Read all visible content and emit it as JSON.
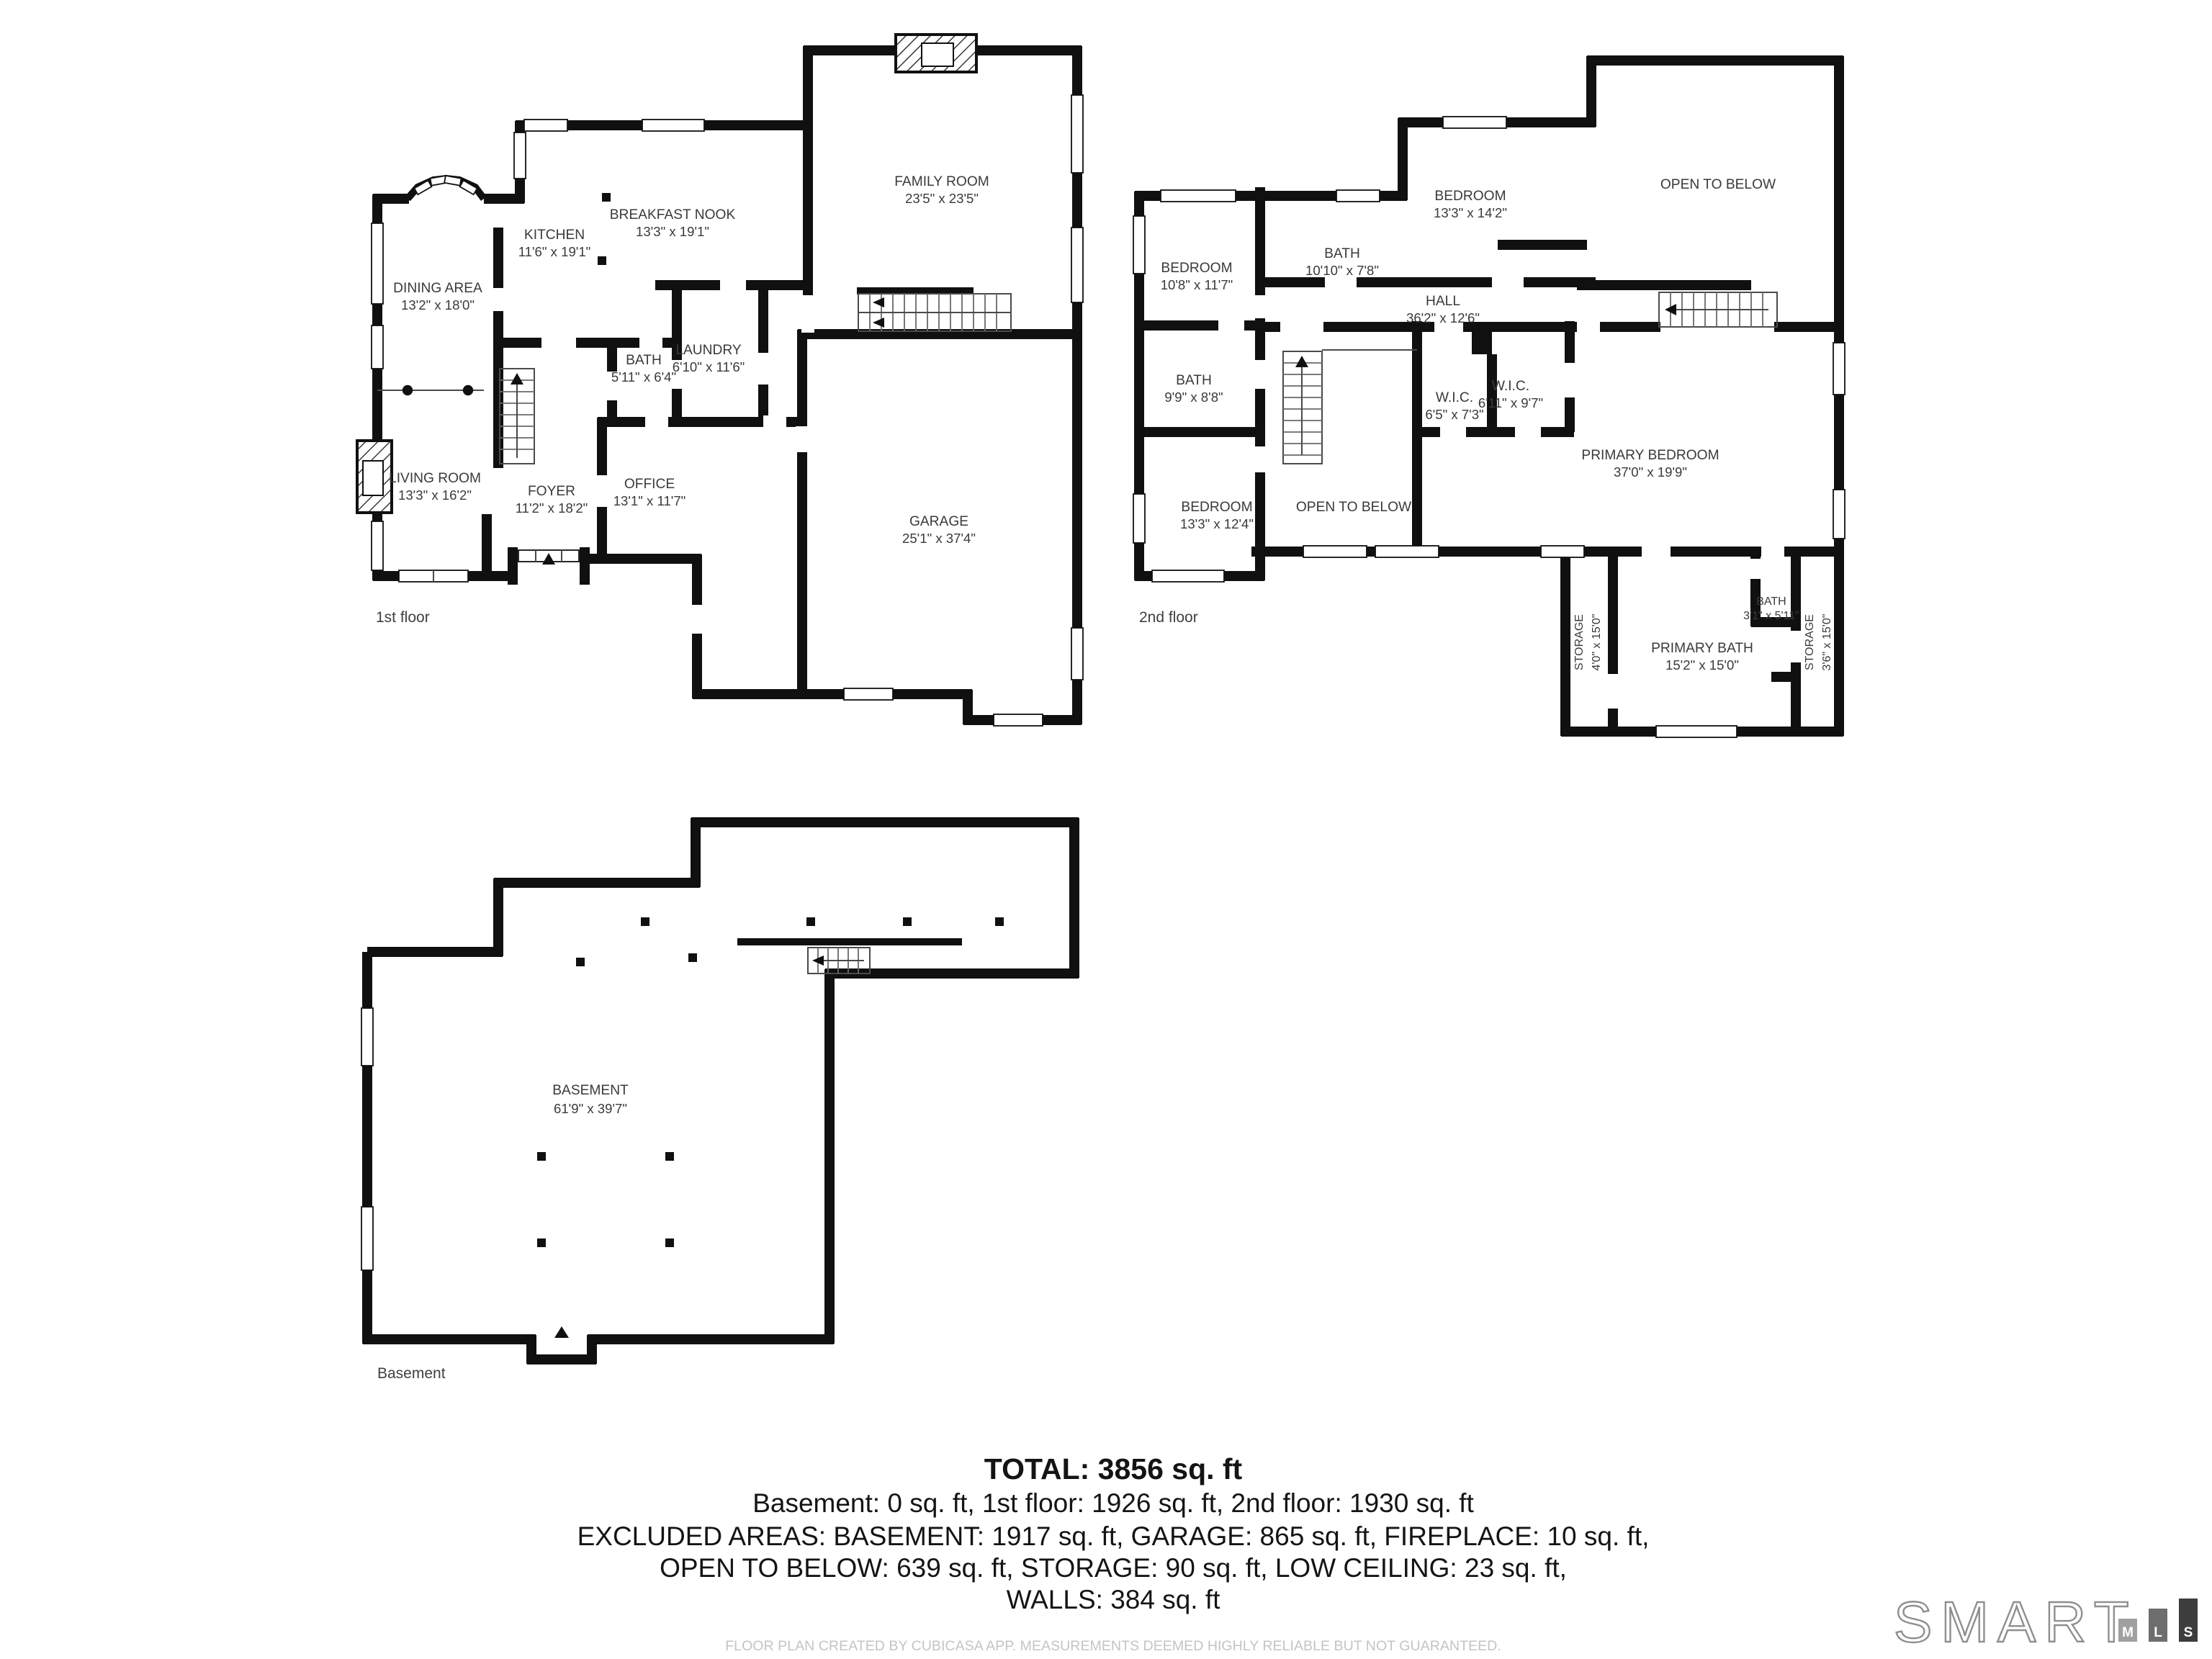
{
  "floors": {
    "first": {
      "label": "1st floor",
      "rooms": {
        "dining": {
          "name": "DINING AREA",
          "dims": "13'2\" x 18'0\""
        },
        "kitchen": {
          "name": "KITCHEN",
          "dims": "11'6\" x 19'1\""
        },
        "breakfast": {
          "name": "BREAKFAST NOOK",
          "dims": "13'3\" x 19'1\""
        },
        "family": {
          "name": "FAMILY ROOM",
          "dims": "23'5\" x 23'5\""
        },
        "bath": {
          "name": "BATH",
          "dims": "5'11\" x 6'4\""
        },
        "laundry": {
          "name": "LAUNDRY",
          "dims": "6'10\" x 11'6\""
        },
        "living": {
          "name": "LIVING ROOM",
          "dims": "13'3\" x 16'2\""
        },
        "foyer": {
          "name": "FOYER",
          "dims": "11'2\" x 18'2\""
        },
        "office": {
          "name": "OFFICE",
          "dims": "13'1\" x 11'7\""
        },
        "garage": {
          "name": "GARAGE",
          "dims": "25'1\" x 37'4\""
        }
      }
    },
    "second": {
      "label": "2nd floor",
      "rooms": {
        "bedroom1": {
          "name": "BEDROOM",
          "dims": "10'8\" x 11'7\""
        },
        "bath1": {
          "name": "BATH",
          "dims": "10'10\" x 7'8\""
        },
        "bedroom2": {
          "name": "BEDROOM",
          "dims": "13'3\" x 14'2\""
        },
        "open_upper": {
          "name": "OPEN TO BELOW",
          "dims": ""
        },
        "hall": {
          "name": "HALL",
          "dims": "36'2\" x 12'6\""
        },
        "bath2": {
          "name": "BATH",
          "dims": "9'9\" x 8'8\""
        },
        "wic1": {
          "name": "W.I.C.",
          "dims": "6'5\" x 7'3\""
        },
        "wic2": {
          "name": "W.I.C.",
          "dims": "6'11\" x 9'7\""
        },
        "primary": {
          "name": "PRIMARY BEDROOM",
          "dims": "37'0\" x 19'9\""
        },
        "bedroom3": {
          "name": "BEDROOM",
          "dims": "13'3\" x 12'4\""
        },
        "open_mid": {
          "name": "OPEN TO BELOW",
          "dims": ""
        },
        "storage1": {
          "name": "STORAGE",
          "dims": "4'0\" x 15'0\""
        },
        "primary_bath": {
          "name": "PRIMARY BATH",
          "dims": "15'2\" x 15'0\""
        },
        "bath3": {
          "name": "BATH",
          "dims": "3'1\" x 5'11\""
        },
        "storage2": {
          "name": "STORAGE",
          "dims": "3'6\" x 15'0\""
        }
      }
    },
    "basement": {
      "label": "Basement",
      "rooms": {
        "basement": {
          "name": "BASEMENT",
          "dims": "61'9\" x 39'7\""
        }
      }
    }
  },
  "summary": {
    "total": "TOTAL: 3856 sq. ft",
    "line1": "Basement: 0 sq. ft, 1st floor: 1926 sq. ft, 2nd floor: 1930 sq. ft",
    "line2": "EXCLUDED AREAS: BASEMENT: 1917 sq. ft, GARAGE: 865 sq. ft, FIREPLACE: 10 sq. ft,",
    "line3": "OPEN TO BELOW: 639 sq. ft, STORAGE: 90 sq. ft, LOW CEILING: 23 sq. ft,",
    "line4": "WALLS: 384 sq. ft"
  },
  "footer": {
    "disclaimer": "FLOOR PLAN CREATED BY CUBICASA APP. MEASUREMENTS DEEMED HIGHLY RELIABLE BUT NOT GUARANTEED."
  },
  "logo": {
    "word": "SMART",
    "m": "M",
    "l": "L",
    "s": "S"
  },
  "colors": {
    "wall": "#101010",
    "room_label": "#3a3a3a",
    "summary_text": "#141414",
    "footer_text": "#c4c4c4",
    "logo_outline": "#8f8f8f",
    "logo_m_bg": "#a0a0a0",
    "logo_l_bg": "#6e6e6e",
    "logo_s_bg": "#3d3d3d"
  }
}
